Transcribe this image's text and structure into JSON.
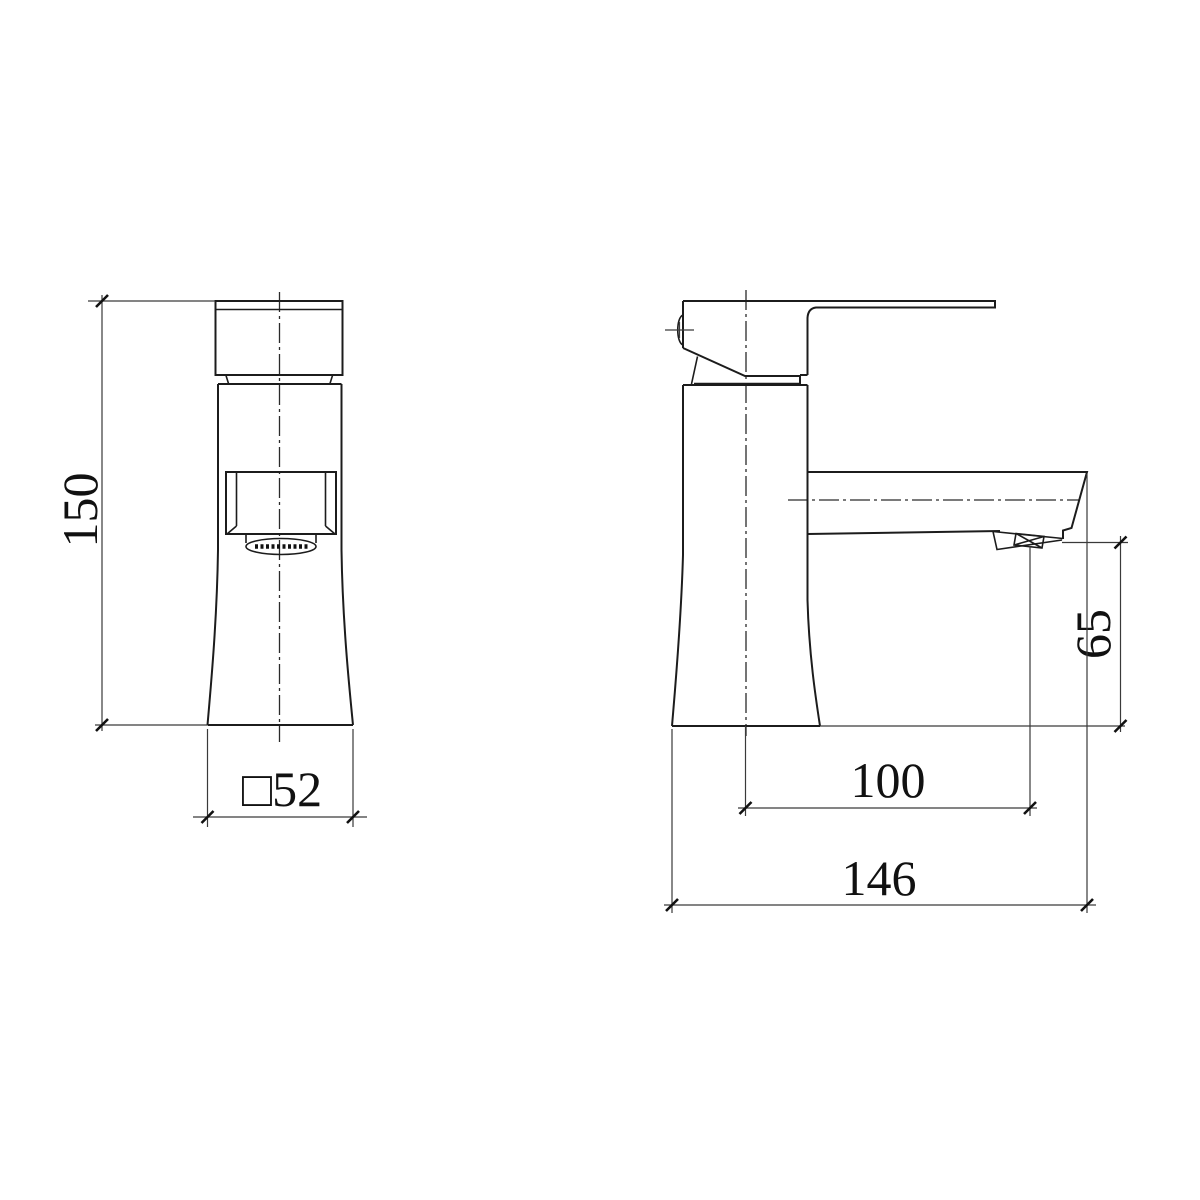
{
  "colors": {
    "background": "#ffffff",
    "line": "#1c1c1c",
    "text": "#111111"
  },
  "drawing": {
    "kind": "orthographic technical drawing of a monobloc basin tap, front view and side view"
  },
  "dimensions": {
    "front_height": "150",
    "front_base_square": "□52",
    "side_outlet_height": "65",
    "side_spout_reach": "100",
    "side_overall_depth": "146"
  }
}
